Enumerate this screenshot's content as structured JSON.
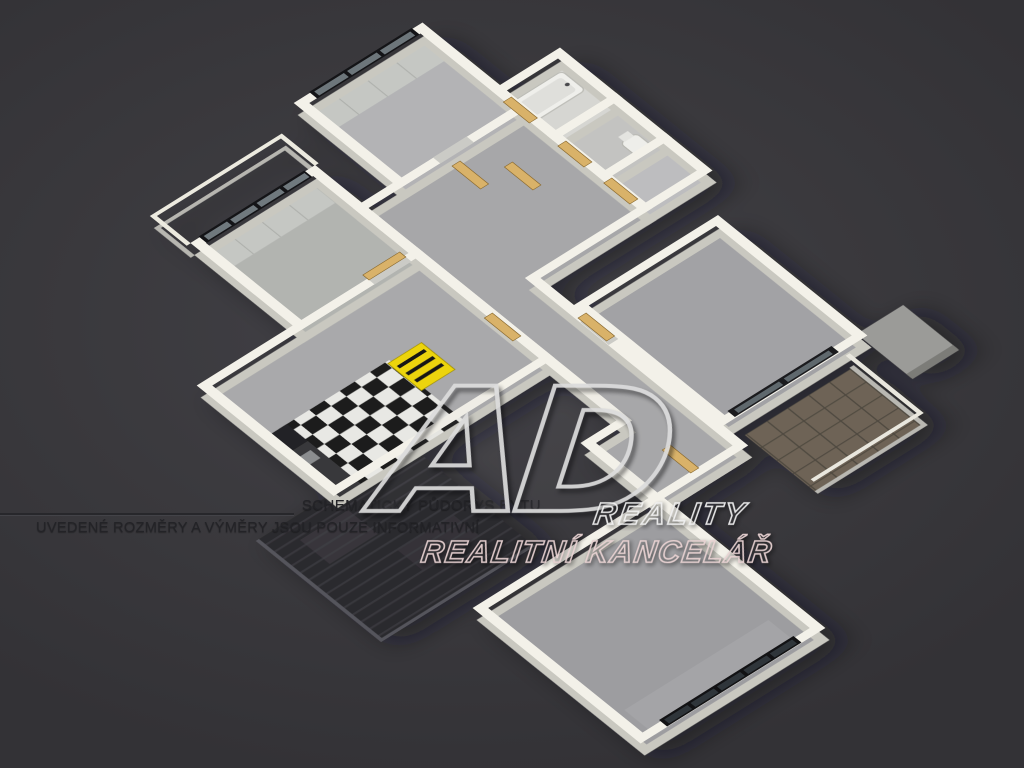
{
  "background": {
    "color": "#3a393d"
  },
  "watermark": {
    "logo": "AD",
    "line1": "REALITY",
    "line2": "REALITNÍ KANCELÁŘ",
    "logo_outline_color": "#dcdcdc",
    "line1_outline_color": "#efefef",
    "line2_outline_color": "#e7d1d1"
  },
  "disclaimer": {
    "line1": "SCHEMATICKÝ PŮDORYS BYTU",
    "line2": "UVEDENÉ ROZMĚRY A VÝMĚRY JSOU POUZE INFORMATIVNÍ",
    "text_color": "#232327"
  },
  "floor_plan": {
    "wall_top_color": "#f3f1e9",
    "wall_side_color": "#c9c8c0",
    "floor_color": "#a7a7a9",
    "door_color": "#d9b269",
    "accent_yellow": "#ecd40c",
    "window_frame_color": "#141417",
    "window_glass_color": "#6e777c",
    "balcony_tile_color": "#6e6456",
    "terrace_color": "#2c2b2f",
    "kitchen_checker_colors": [
      "#e8e8e4",
      "#1a1a1a"
    ]
  }
}
